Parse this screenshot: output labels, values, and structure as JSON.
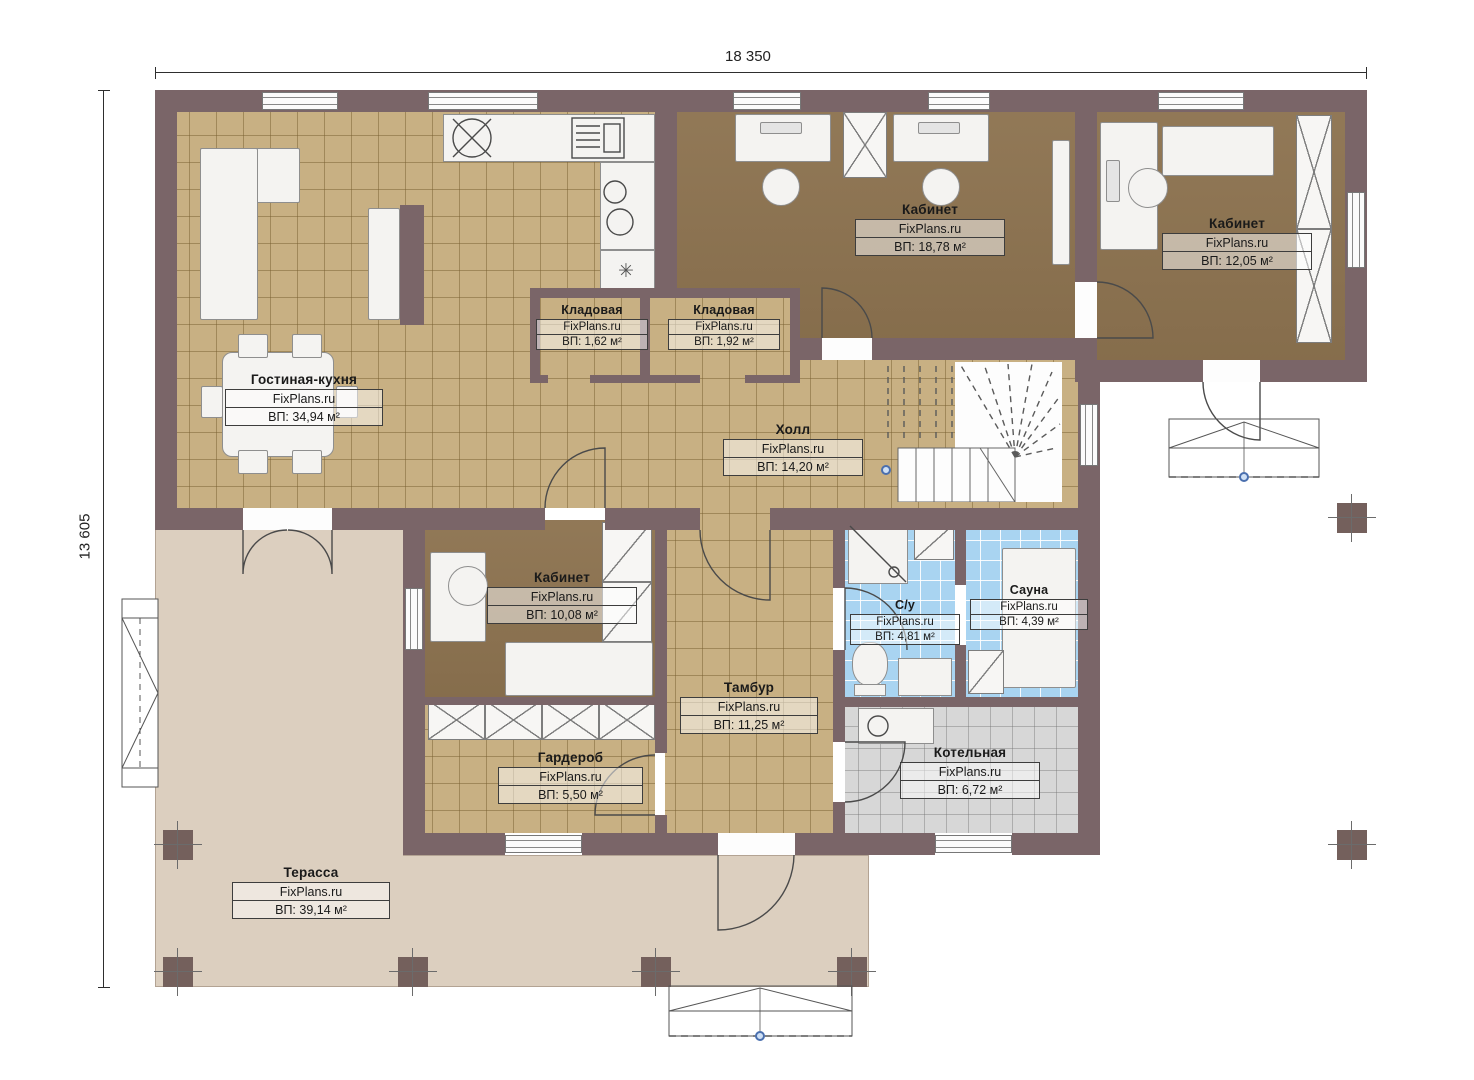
{
  "plan": {
    "brand": "FixPlans.ru",
    "dimensions": {
      "width_label": "18 350",
      "height_label": "13 605"
    },
    "rooms": [
      {
        "name": "Гостиная-кухня",
        "brand": "FixPlans.ru",
        "area": "ВП: 34,94 м²"
      },
      {
        "name": "Кабинет",
        "brand": "FixPlans.ru",
        "area": "ВП: 18,78 м²"
      },
      {
        "name": "Кабинет",
        "brand": "FixPlans.ru",
        "area": "ВП: 12,05 м²"
      },
      {
        "name": "Кладовая",
        "brand": "FixPlans.ru",
        "area": "ВП: 1,62 м²"
      },
      {
        "name": "Кладовая",
        "brand": "FixPlans.ru",
        "area": "ВП: 1,92 м²"
      },
      {
        "name": "Холл",
        "brand": "FixPlans.ru",
        "area": "ВП: 14,20 м²"
      },
      {
        "name": "Кабинет",
        "brand": "FixPlans.ru",
        "area": "ВП: 10,08 м²"
      },
      {
        "name": "С/у",
        "brand": "FixPlans.ru",
        "area": "ВП: 4,81 м²"
      },
      {
        "name": "Сауна",
        "brand": "FixPlans.ru",
        "area": "ВП: 4,39 м²"
      },
      {
        "name": "Тамбур",
        "brand": "FixPlans.ru",
        "area": "ВП: 11,25 м²"
      },
      {
        "name": "Гардероб",
        "brand": "FixPlans.ru",
        "area": "ВП: 5,50 м²"
      },
      {
        "name": "Котельная",
        "brand": "FixPlans.ru",
        "area": "ВП: 6,72 м²"
      },
      {
        "name": "Терасса",
        "brand": "FixPlans.ru",
        "area": "ВП: 39,14 м²"
      }
    ],
    "icons": {
      "appliance": "✳"
    },
    "colors": {
      "wall": "#7a6568",
      "floor_tan": "#c8b083",
      "floor_office": "#8d7350",
      "tile_blue": "#a9d4f1",
      "tile_gray": "#d7d7d7",
      "terrace": "#dccfbf",
      "furniture": "#f4f3f1",
      "marker_blue": "#4a6fae"
    }
  }
}
